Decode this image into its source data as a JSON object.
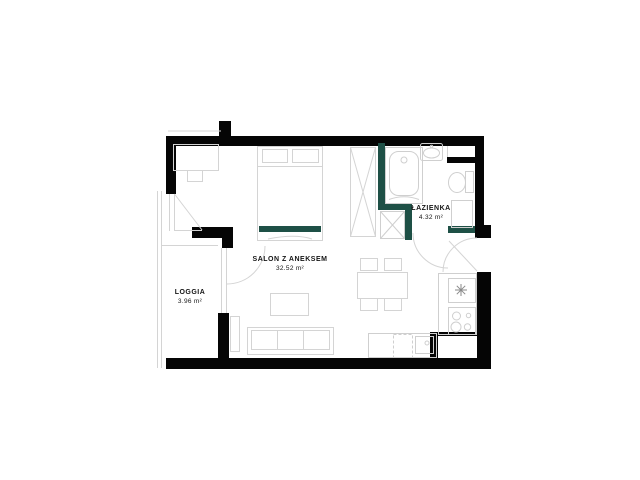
{
  "rooms": {
    "salon": {
      "name": "SALON Z ANEKSEM",
      "area": "32.52 m²"
    },
    "lazienka": {
      "name": "ŁAZIENKA",
      "area": "4.32 m²"
    },
    "loggia": {
      "name": "LOGGIA",
      "area": "3.96 m²"
    }
  },
  "colors": {
    "wall": "#050505",
    "partition": "#1e5046",
    "line": "#d4d4d4",
    "fixline": "#cfcfcf",
    "star": "#8a8a8a",
    "text": "#141414",
    "bg": "#ffffff"
  },
  "fixtures": [
    "double-bed",
    "bed-runner",
    "bed-bench",
    "desk",
    "desk-chair",
    "radiator",
    "sofa",
    "coffee-table",
    "dining-table",
    "dining-chair",
    "wardrobe",
    "washing-machine",
    "bathtub",
    "washbasin",
    "toilet",
    "bathroom-cabinet",
    "kitchen-counter",
    "kitchen-sink",
    "sink-star",
    "hob",
    "dishwasher",
    "fridge-niche",
    "entry-door-arc",
    "bathroom-door-arc",
    "loggia-door-arc",
    "window-casement"
  ]
}
